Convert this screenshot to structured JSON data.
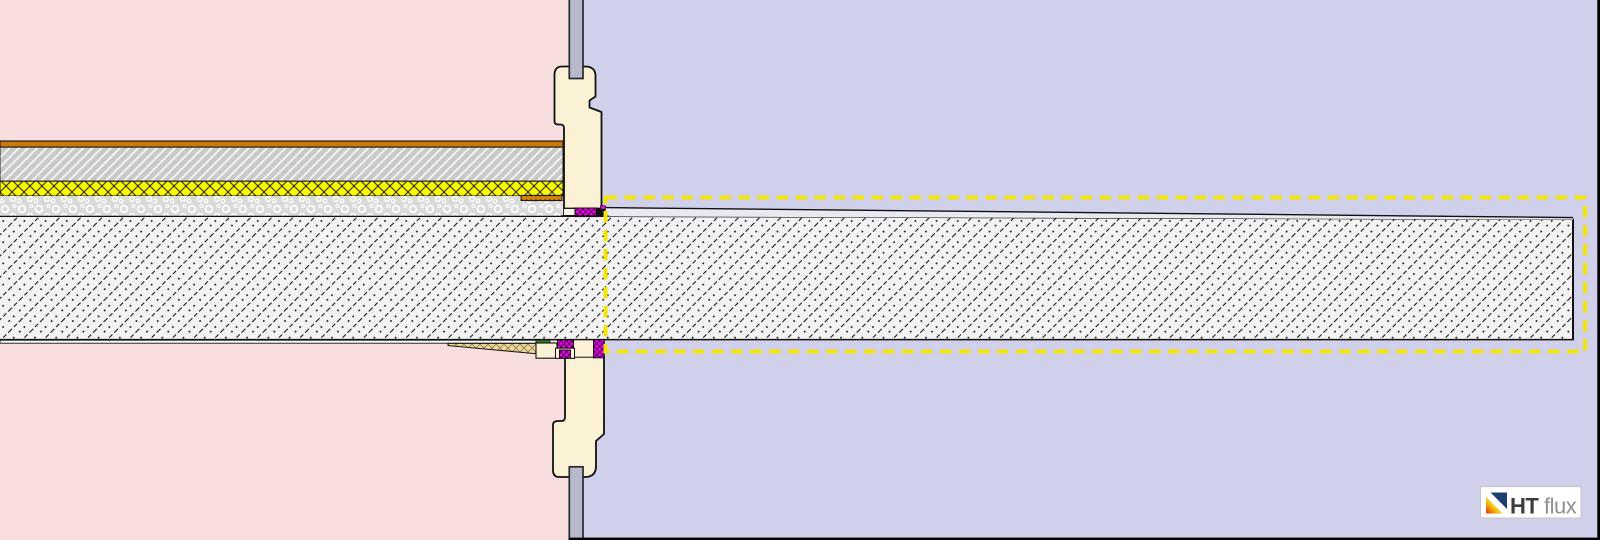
{
  "app": {
    "logo_primary": "HT",
    "logo_secondary": "flux"
  },
  "colors": {
    "interior_background": "#f9dee0",
    "exterior_background": "#d1d0eb",
    "window_frame": "#fbf2d5",
    "glazing": "#b7b9cb",
    "selection_dash": "#f2e50a",
    "floor_finish": "#c8790a",
    "screed": "#c9c9c9",
    "insulation": "#f8f804",
    "fill_layer": "#dadada",
    "concrete": "#f3f3f3",
    "seal": "#ee00ee",
    "wedge": "#ead9a2",
    "slope_layer": "#e9e9f1",
    "plaster": "#fdfdfd",
    "sealing_tape": "#2e7d1e",
    "support_strip": "#d4820a",
    "frame_border": "#000000",
    "logo_primary": "#3c3c3c",
    "logo_secondary": "#8f8f8f",
    "logo_navy": "#1e3f72"
  }
}
